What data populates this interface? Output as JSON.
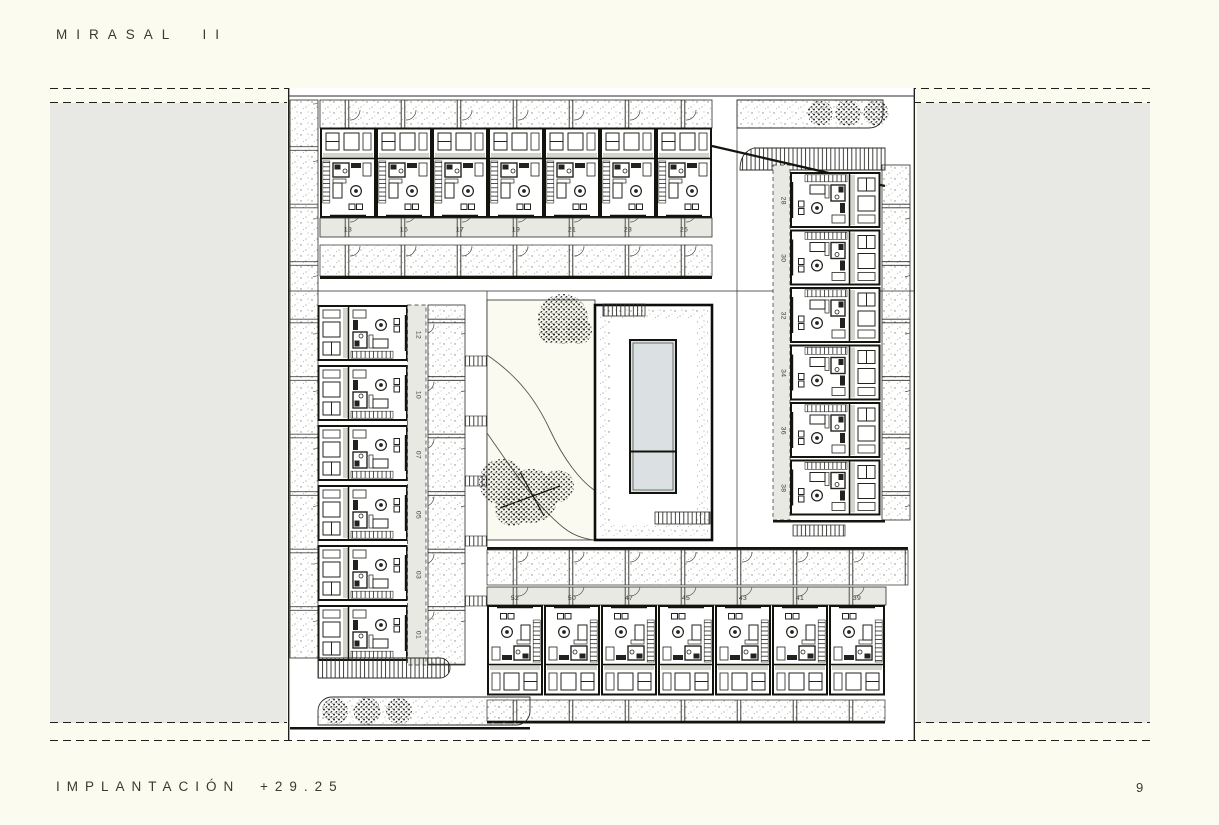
{
  "header": {
    "title": "MIRASAL II"
  },
  "footer": {
    "title": "IMPLANTACIÓN +29.25",
    "page_number": "9"
  },
  "plan": {
    "top_row": [
      "13",
      "15",
      "17",
      "19",
      "21",
      "23",
      "25"
    ],
    "right_col": [
      "28",
      "30",
      "32",
      "34",
      "36",
      "38"
    ],
    "left_col": [
      "12",
      "10",
      "07",
      "05",
      "03",
      "01"
    ],
    "bottom_row": [
      "52",
      "50",
      "47",
      "45",
      "43",
      "41",
      "39"
    ],
    "colors": {
      "paper": "#fbfbef",
      "side_panel": "#e8e8e5",
      "number_band": "#e9e9e4",
      "pool_water": "#dbe1e2",
      "drawing_line": "#161613"
    }
  }
}
